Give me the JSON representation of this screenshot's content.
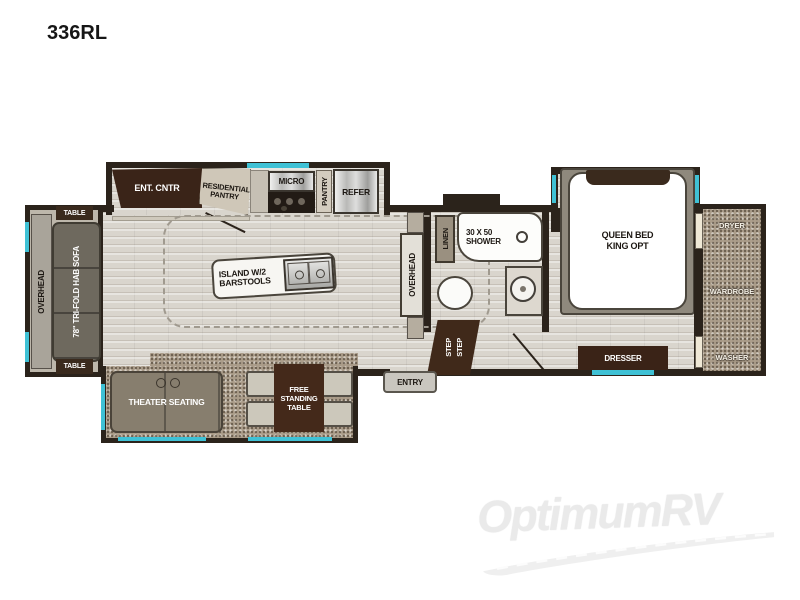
{
  "title": "336RL",
  "watermark": {
    "brand": "OptimumRV"
  },
  "colors": {
    "wall": "#2b231b",
    "window_accent": "#3fc1d5",
    "dark_furniture": "#3a2517",
    "floor_wood": "#d9d5cd",
    "carpet": "#ab9d8a"
  },
  "labels": {
    "overhead_left": "OVERHEAD",
    "table_top": "TABLE",
    "table_bottom": "TABLE",
    "sofa": "78\" TRI-FOLD HAB SOFA",
    "ent_cntr": "ENT. CNTR",
    "residential_pantry": "RESIDENTIAL PANTRY",
    "micro": "MICRO",
    "pantry": "PANTRY",
    "refer": "REFER",
    "island": "ISLAND W/2 BARSTOOLS",
    "overhead_bath": "OVERHEAD",
    "linen": "LINEN",
    "shower": "30 X 50 SHOWER",
    "queen_bed": "QUEEN BED KING OPT",
    "dresser": "DRESSER",
    "dryer": "DRYER",
    "wardrobe": "WARDROBE",
    "washer": "WASHER",
    "step_1": "STEP",
    "step_2": "STEP",
    "entry": "ENTRY",
    "theater_seating": "THEATER SEATING",
    "free_standing_table": "FREE STANDING TABLE"
  }
}
